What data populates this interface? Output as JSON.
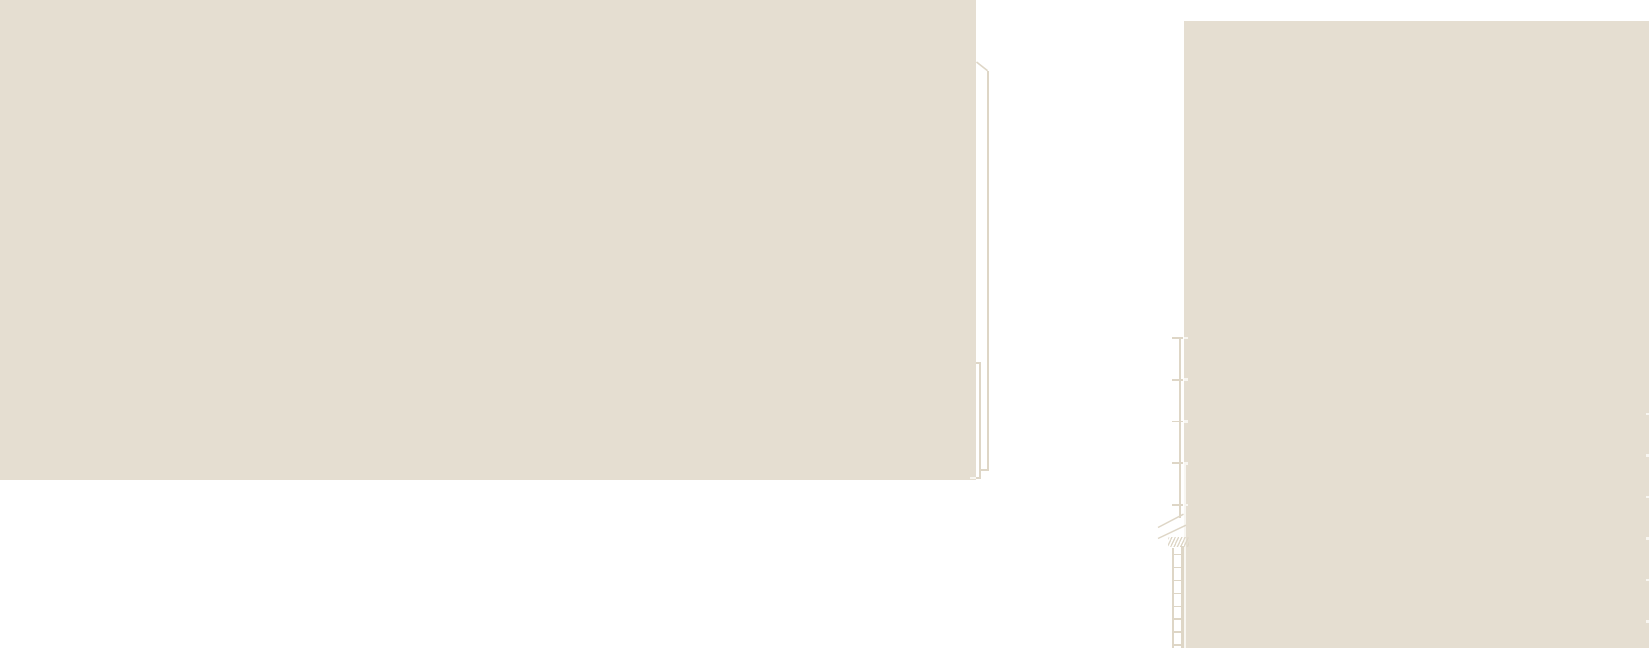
{
  "meta": {
    "description": "Zoomed-in fragment of an architectural section/elevation drawing: white canvas with two solid beige paper masses and very fine construction linework (offset edge lines, ruler line with ticks, a small ladder in section, brace diagonals, break-line scribble, edge notches). No visible text."
  },
  "canvas": {
    "width": 1649,
    "height": 648
  },
  "colors": {
    "canvas_bg": "#ffffff",
    "paper": "#e5ded1",
    "line_on_white": "#ded6c6",
    "line_on_paper": "#f8f6f1"
  },
  "blocks": {
    "left_mass": {
      "x": 0,
      "y": 0,
      "w": 976,
      "h": 480
    },
    "right_mass": {
      "x": 1184,
      "y": 21,
      "w": 465,
      "h": 627
    }
  },
  "left_edge_detail": {
    "outer_vline": {
      "x": 986.9,
      "y": 70.5,
      "w": 1.7,
      "h": 400.5
    },
    "outer_foot": {
      "x": 980.4,
      "y": 469.4,
      "w": 8.2,
      "h": 1.8
    },
    "inner_vline": {
      "x": 978.8,
      "y": 362,
      "w": 1.9,
      "h": 117
    },
    "inner_cap": {
      "x": 976,
      "y": 361.8,
      "w": 4.8,
      "h": 1.8
    },
    "inner_foot": {
      "x": 976,
      "y": 476.7,
      "w": 4.9,
      "h": 2
    },
    "foot_notch": {
      "x": 969.5,
      "y": 476.5,
      "w": 6.5,
      "h": 2.2
    }
  },
  "ruler": {
    "vline": {
      "x": 1178.7,
      "y": 337,
      "w": 2,
      "h": 181
    },
    "ticks": {
      "ys": [
        337.7,
        379.6,
        421.5,
        463.4,
        505.3
      ],
      "x": 1171.6,
      "w": 11.9,
      "h": 1.9
    },
    "edge_notches": {
      "ys": [
        337.7,
        379.6,
        421.5,
        463.4,
        505.3
      ],
      "x": 1184,
      "w": 3.6,
      "h": 2.4
    }
  },
  "seam": {
    "x": 1184,
    "y": 463,
    "w": 1.9,
    "h": 185
  },
  "ladder": {
    "rail_left": {
      "x": 1172,
      "y": 548,
      "w": 2.2,
      "h": 100
    },
    "rail_right": {
      "x": 1181.3,
      "y": 546,
      "w": 2.3,
      "h": 102
    },
    "rungs": {
      "ys": [
        554.5,
        567.5,
        580.5,
        593.5,
        606.5,
        619,
        632,
        645
      ],
      "x": 1172,
      "w": 11.6,
      "h": 1.9
    },
    "scribble": {
      "x": 1167.5,
      "y": 536.5,
      "w": 21,
      "h": 10.5
    }
  },
  "right_edge_notches": {
    "ys": [
      414,
      455.5,
      497,
      538.5,
      580,
      621.5
    ],
    "x": 1646.2,
    "w": 2.8,
    "h": 2.4
  },
  "diagonals": [
    {
      "name": "corner-diagonal-line",
      "x1": 976.5,
      "y1": 62,
      "x2": 987.6,
      "y2": 70.8,
      "w": 1.6
    },
    {
      "name": "brace-line-upper",
      "x1": 1158,
      "y1": 527.5,
      "x2": 1183.5,
      "y2": 514.2,
      "w": 1.5
    },
    {
      "name": "brace-line-lower",
      "x1": 1158,
      "y1": 538.5,
      "x2": 1186,
      "y2": 525.2,
      "w": 1.5
    }
  ]
}
